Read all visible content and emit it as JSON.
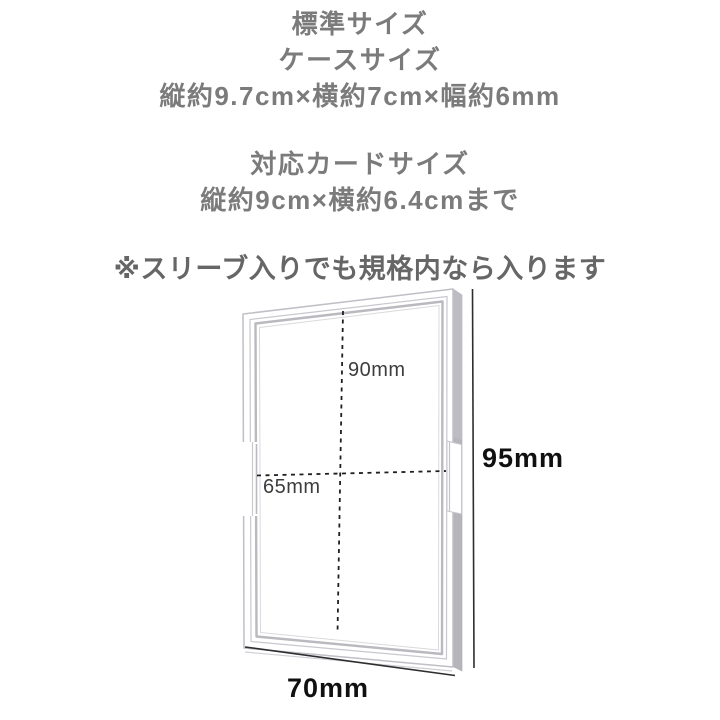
{
  "header": {
    "standard_size": "標準サイズ",
    "case_size_label": "ケースサイズ",
    "case_dimensions": "縦約9.7cm×横約7cm×幅約6mm",
    "card_size_label": "対応カードサイズ",
    "card_dimensions": "縦約9cm×横約6.4cmまで",
    "note": "※スリーブ入りでも規格内なら入ります"
  },
  "diagram": {
    "labels": {
      "inner_height": "90mm",
      "inner_width": "65mm",
      "outer_height": "95mm",
      "outer_width": "70mm"
    },
    "colors": {
      "header_text": "#7b7b7b",
      "note_text": "#666666",
      "case_outline": "#bfbfc5",
      "case_side_face": "#b5b5bb",
      "dashed_line": "#1f1f1f",
      "dimension_line": "#2e2e2e",
      "small_label_text": "#3d3d3d",
      "big_label_text": "#101010"
    }
  }
}
